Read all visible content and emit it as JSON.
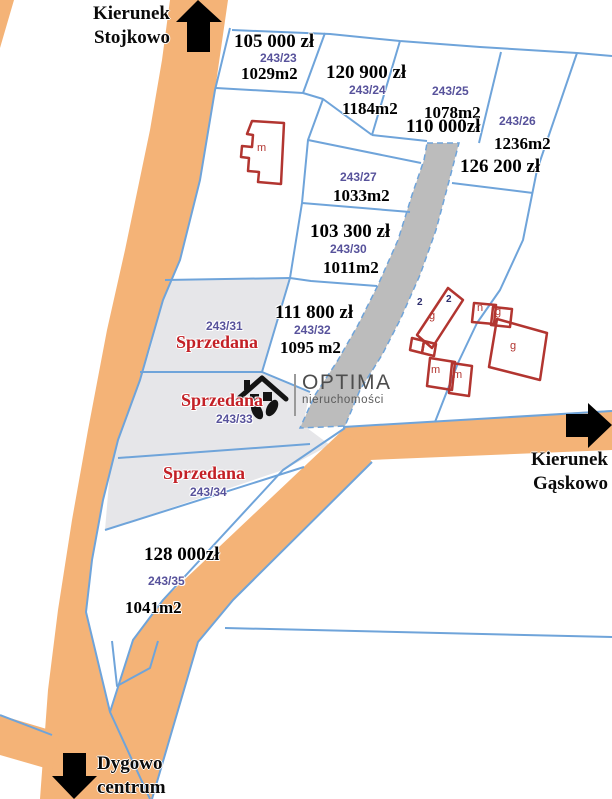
{
  "map": {
    "directions": {
      "stojkowo": {
        "line1": "Kierunek",
        "line2": "Stojkowo"
      },
      "gaskowo": {
        "line1": "Kierunek",
        "line2": "Gąskowo"
      },
      "dygowo": {
        "line1": "Dygowo",
        "line2": "centrum"
      }
    },
    "plots": [
      {
        "number": "243/23",
        "price": "105 000 zł",
        "area": "1029m2"
      },
      {
        "number": "243/24",
        "price": "120 900 zł",
        "area": "1184m2"
      },
      {
        "number": "243/25",
        "price": "110 000zł",
        "area": "1078m2"
      },
      {
        "number": "243/26",
        "price": "126 200 zł",
        "area": "1236m2"
      },
      {
        "number": "243/27",
        "area": "1033m2"
      },
      {
        "number": "243/30",
        "price": "103 300 zł",
        "area": "1011m2"
      },
      {
        "number": "243/31",
        "status": "Sprzedana"
      },
      {
        "number": "243/32",
        "price": "111 800 zł",
        "area": "1095 m2"
      },
      {
        "number": "243/33",
        "status": "Sprzedana"
      },
      {
        "number": "243/34",
        "status": "Sprzedana"
      },
      {
        "number": "243/35",
        "price": "128 000zł",
        "area": "1041m2"
      }
    ],
    "building_labels": {
      "house_m": "m",
      "garage1": "g",
      "house2_m": "m",
      "house3_m": "m",
      "outbuilding_n": "n",
      "garage2": "g",
      "garage3": "g"
    },
    "address_numbers": [
      "2",
      "2"
    ],
    "logo": {
      "brand": "OPTIMA",
      "subtitle": "nieruchomości"
    },
    "colors": {
      "road": "#f4b377",
      "parcel_line": "#6fa4da",
      "sold_fill": "#e6e6e9",
      "driveway_fill": "#bcbcbc",
      "plot_number_text": "#57529b",
      "sold_text": "#c32026",
      "building_outline": "#b23530",
      "arrow": "#000000"
    }
  }
}
